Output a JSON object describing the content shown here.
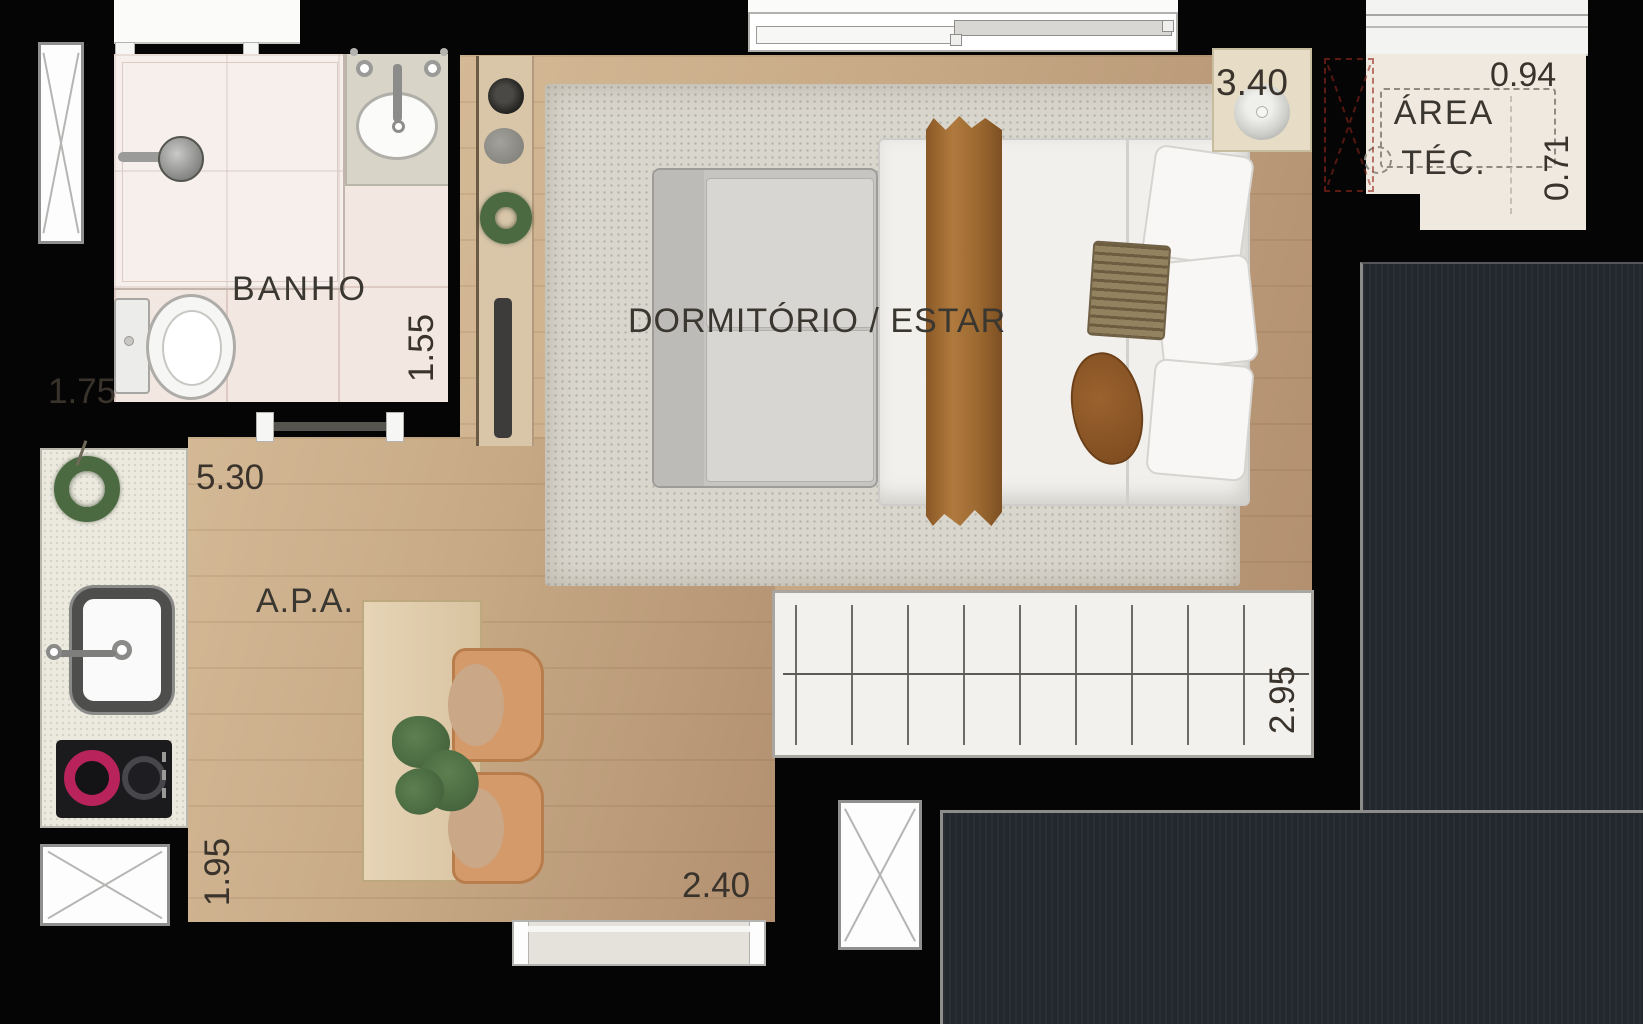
{
  "meta": {
    "type": "apartment-floor-plan"
  },
  "rooms": {
    "banho": {
      "label": "BANHO"
    },
    "dormitorio": {
      "label": "DORMITÓRIO / ESTAR"
    },
    "apa": {
      "label": "A.P.A."
    },
    "area_tec": {
      "line1": "ÁREA",
      "line2": "TÉC."
    }
  },
  "dimensions": {
    "banho_width": "1.75",
    "banho_depth": "1.55",
    "apa_length": "5.30",
    "apa_width": "1.95",
    "dining_width": "2.40",
    "dormitorio_length": "3.40",
    "dormitorio_depth": "2.95",
    "area_tec_width": "0.94",
    "area_tec_depth": "0.71"
  },
  "colors": {
    "background": "#050505",
    "wood_floor": "#c9ab87",
    "bath_floor": "#f3e7e1",
    "rug": "#d9d6cd",
    "dark_panel": "#23272e",
    "chair_orange": "#d49a6a",
    "blanket_brown": "#9a6a35",
    "plant_green": "#4c6a42",
    "accent_red_dashed": "#96281c"
  }
}
